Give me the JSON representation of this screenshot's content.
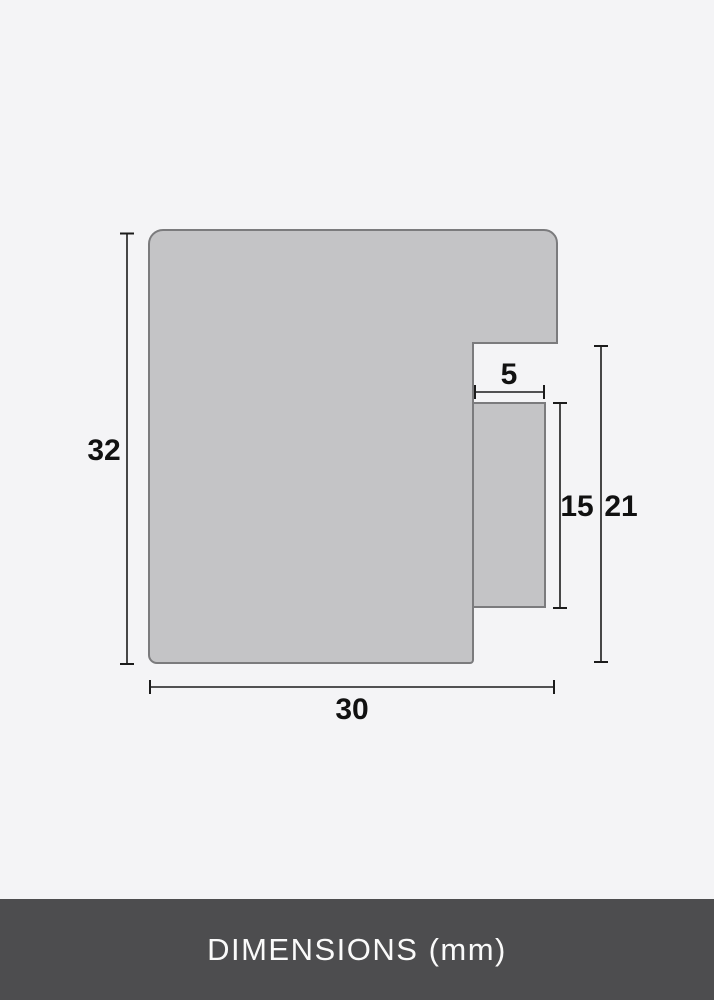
{
  "diagram": {
    "unit": "mm",
    "dimensions": {
      "total_height": "32",
      "rabbet_width": "5",
      "lip_height": "15",
      "back_height": "21",
      "total_width": "30"
    }
  },
  "footer": {
    "label": "DIMENSIONS (mm)"
  },
  "colors": {
    "background": "#f4f4f6",
    "profile_fill": "#c4c4c6",
    "profile_stroke": "#7b7b7d",
    "dimension_line": "#1b1b1b",
    "dimension_text": "#111111",
    "footer_background": "#4d4d4f",
    "footer_text": "#fafafa"
  }
}
